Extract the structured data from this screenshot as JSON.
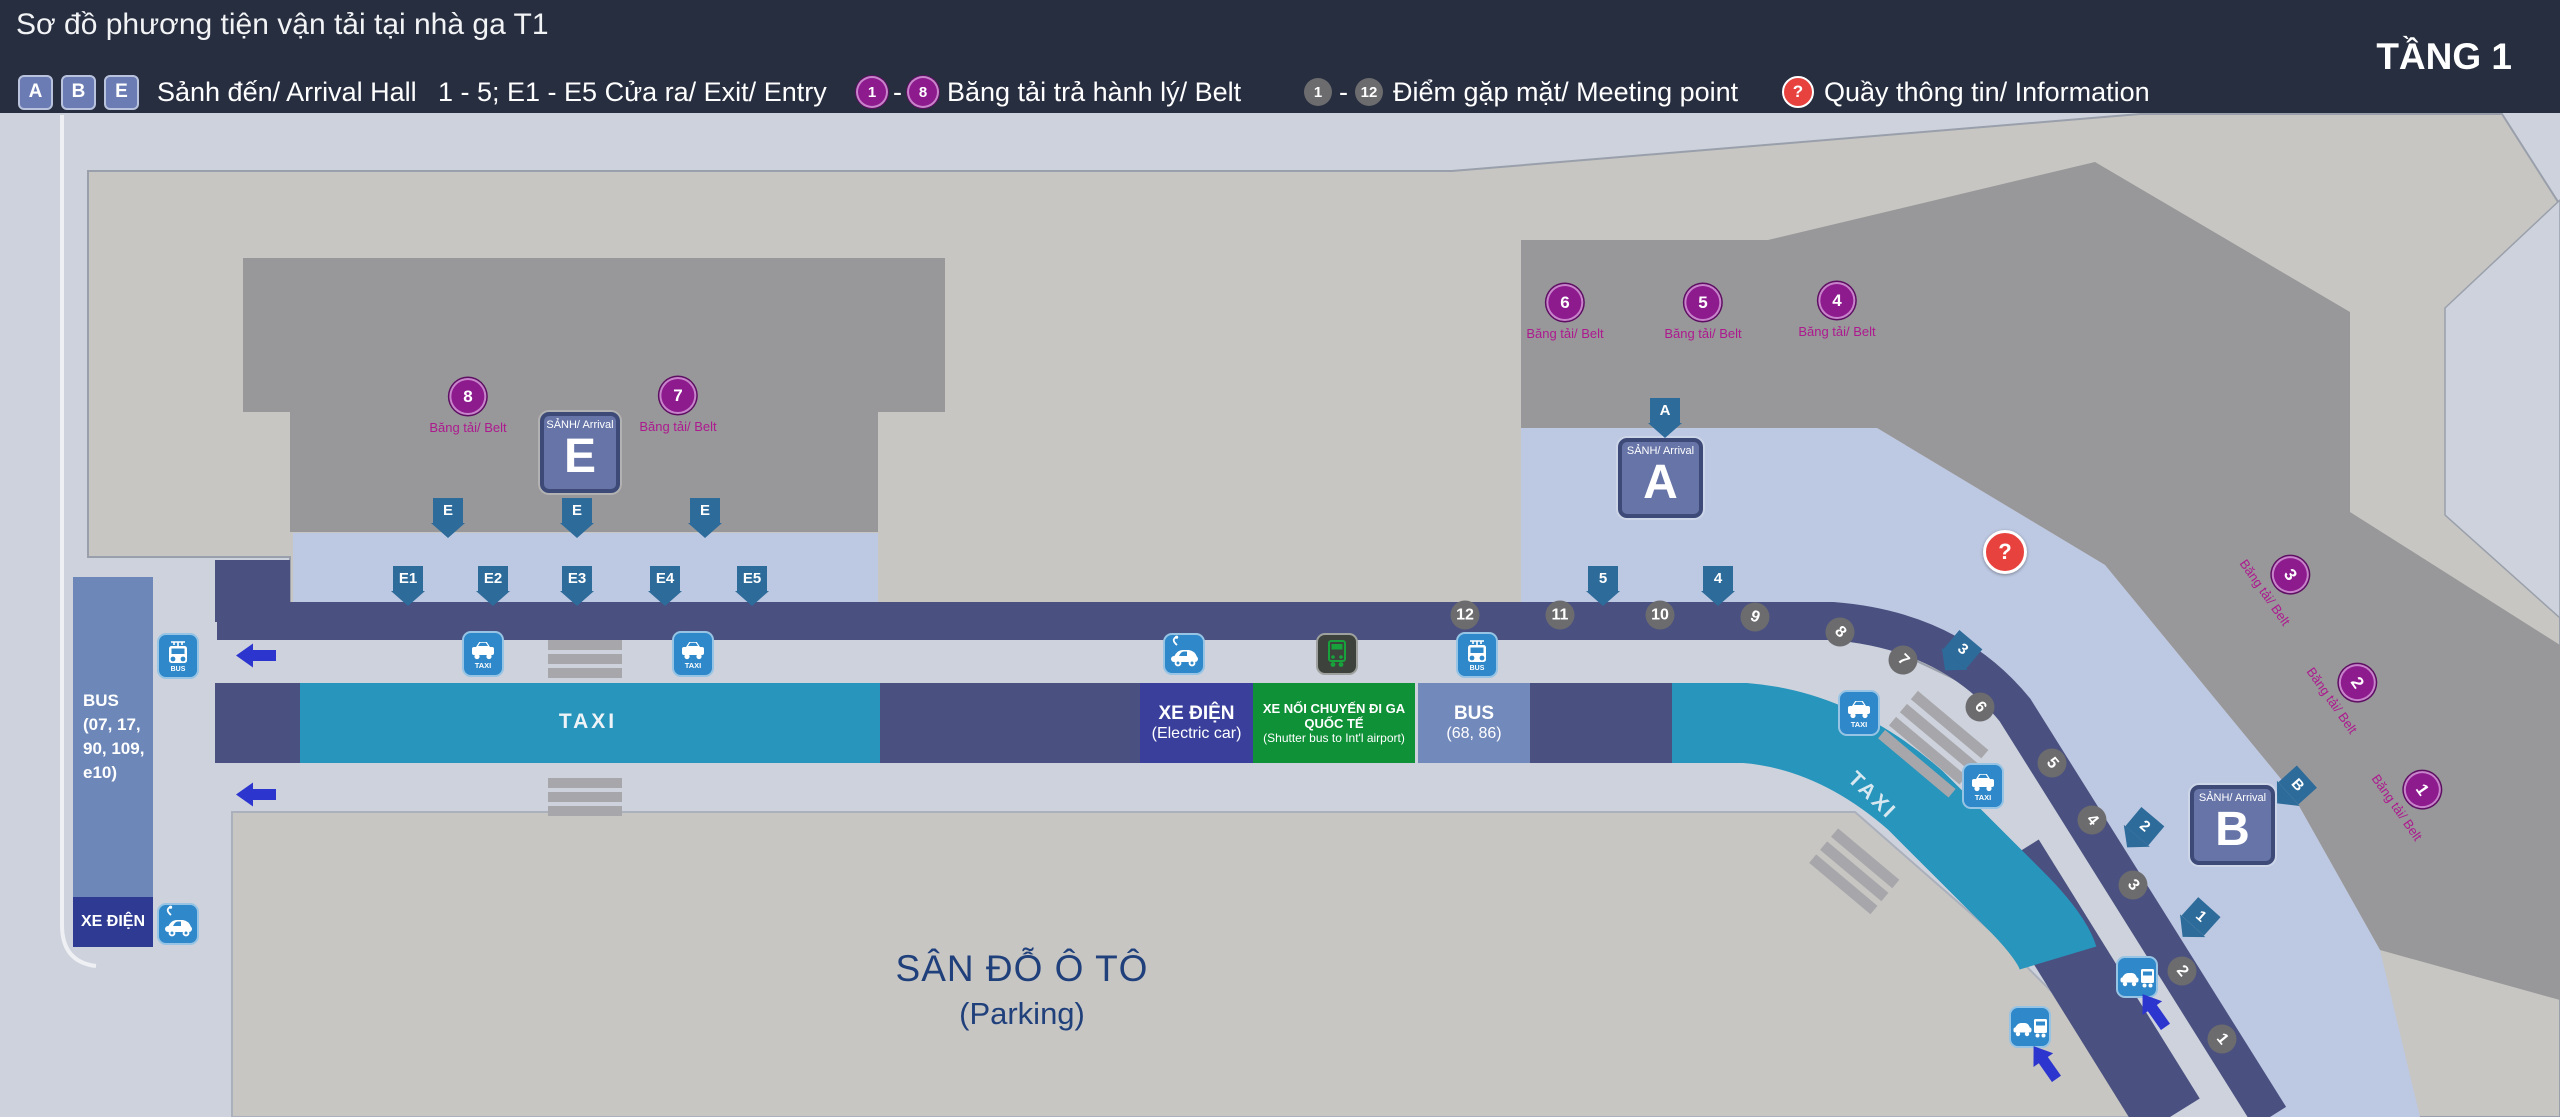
{
  "header": {
    "title": "Sơ đồ phương tiện vận tải tại nhà ga T1",
    "floor": "TẦNG 1",
    "legend": {
      "halls": {
        "badges": [
          "A",
          "B",
          "E"
        ],
        "label": "Sảnh đến/ Arrival Hall"
      },
      "exits": {
        "label": "1 - 5; E1 - E5 Cửa ra/ Exit/ Entry"
      },
      "belts": {
        "from": "1",
        "dash": "-",
        "to": "8",
        "label": "Băng tải trả hành lý/ Belt"
      },
      "meetings": {
        "from": "1",
        "dash": "-",
        "to": "12",
        "label": "Điểm gặp mặt/ Meeting point"
      },
      "info": {
        "symbol": "?",
        "label": "Quầy thông tin/ Information"
      }
    }
  },
  "map": {
    "parking": {
      "line1": "SÂN ĐỖ Ô TÔ",
      "line2": "(Parking)"
    },
    "bus_bay": {
      "lines": [
        "BUS",
        "(07, 17,",
        "90, 109,",
        "e10)"
      ]
    },
    "xe_dien_bay": {
      "label": "XE ĐIỆN"
    },
    "taxi_band": {
      "label": "TAXI"
    },
    "taxi_band_diagonal": {
      "label": "TAXI"
    },
    "boxes": {
      "electric": {
        "line1": "XE ĐIỆN",
        "line2": "(Electric car)"
      },
      "shuttle": {
        "line1": "XE NỐI CHUYẾN ĐI GA QUỐC TẾ",
        "line2": "(Shutter bus to Int'l airport)"
      },
      "bus": {
        "line1": "BUS",
        "line2": "(68, 86)"
      }
    },
    "arrival_boxes": [
      {
        "id": "E",
        "small": "SẢNH/ Arrival",
        "letter": "E",
        "x": 540,
        "y": 412,
        "w": 80,
        "h": 81
      },
      {
        "id": "A",
        "small": "SẢNH/ Arrival",
        "letter": "A",
        "x": 1618,
        "y": 438,
        "w": 85,
        "h": 80
      },
      {
        "id": "B",
        "small": "SẢNH/ Arrival",
        "letter": "B",
        "x": 2190,
        "y": 785,
        "w": 85,
        "h": 80
      }
    ],
    "info_point": {
      "symbol": "?",
      "x": 2005,
      "y": 552
    },
    "belt_label": "Băng tải/ Belt",
    "belts": [
      {
        "n": "8",
        "x": 468,
        "y": 397,
        "r": 0
      },
      {
        "n": "7",
        "x": 678,
        "y": 396,
        "r": 0
      },
      {
        "n": "6",
        "x": 1565,
        "y": 303,
        "r": 0
      },
      {
        "n": "5",
        "x": 1703,
        "y": 303,
        "r": 0
      },
      {
        "n": "4",
        "x": 1837,
        "y": 301,
        "r": 0
      },
      {
        "n": "3",
        "x": 2290,
        "y": 575,
        "r": 55
      },
      {
        "n": "2",
        "x": 2357,
        "y": 683,
        "r": 55
      },
      {
        "n": "1",
        "x": 2422,
        "y": 790,
        "r": 55
      }
    ],
    "meetings": [
      {
        "n": "12",
        "x": 1465,
        "y": 615,
        "r": 0
      },
      {
        "n": "11",
        "x": 1560,
        "y": 615,
        "r": 0
      },
      {
        "n": "10",
        "x": 1660,
        "y": 615,
        "r": 0
      },
      {
        "n": "9",
        "x": 1755,
        "y": 617,
        "r": 20
      },
      {
        "n": "8",
        "x": 1840,
        "y": 632,
        "r": 45
      },
      {
        "n": "7",
        "x": 1903,
        "y": 660,
        "r": 45
      },
      {
        "n": "6",
        "x": 1980,
        "y": 707,
        "r": 50
      },
      {
        "n": "5",
        "x": 2052,
        "y": 763,
        "r": 50
      },
      {
        "n": "4",
        "x": 2092,
        "y": 820,
        "r": 50
      },
      {
        "n": "3",
        "x": 2133,
        "y": 885,
        "r": 50
      },
      {
        "n": "2",
        "x": 2182,
        "y": 971,
        "r": 50
      },
      {
        "n": "1",
        "x": 2222,
        "y": 1039,
        "r": 50
      }
    ],
    "exits": [
      {
        "t": "E",
        "x": 448,
        "y": 498,
        "r": 0
      },
      {
        "t": "E",
        "x": 577,
        "y": 498,
        "r": 0
      },
      {
        "t": "E",
        "x": 705,
        "y": 498,
        "r": 0
      },
      {
        "t": "E1",
        "x": 408,
        "y": 566,
        "r": 0
      },
      {
        "t": "E2",
        "x": 493,
        "y": 566,
        "r": 0
      },
      {
        "t": "E3",
        "x": 577,
        "y": 566,
        "r": 0
      },
      {
        "t": "E4",
        "x": 665,
        "y": 566,
        "r": 0
      },
      {
        "t": "E5",
        "x": 752,
        "y": 566,
        "r": 0
      },
      {
        "t": "A",
        "x": 1665,
        "y": 398,
        "r": 0
      },
      {
        "t": "5",
        "x": 1603,
        "y": 566,
        "r": 0
      },
      {
        "t": "4",
        "x": 1718,
        "y": 566,
        "r": 0
      },
      {
        "t": "3",
        "x": 1958,
        "y": 635,
        "r": 40
      },
      {
        "t": "2",
        "x": 2140,
        "y": 812,
        "r": 40
      },
      {
        "t": "1",
        "x": 2196,
        "y": 902,
        "r": 42
      },
      {
        "t": "B",
        "x": 2292,
        "y": 770,
        "r": 48
      }
    ],
    "icons": [
      {
        "type": "bus",
        "x": 178,
        "y": 656,
        "label": "BUS"
      },
      {
        "type": "ecar",
        "x": 178,
        "y": 924,
        "label": ""
      },
      {
        "type": "taxi",
        "x": 483,
        "y": 654,
        "label": "TAXI"
      },
      {
        "type": "taxi",
        "x": 693,
        "y": 654,
        "label": "TAXI"
      },
      {
        "type": "ecar",
        "x": 1184,
        "y": 654,
        "label": ""
      },
      {
        "type": "shuttle",
        "x": 1337,
        "y": 654,
        "label": ""
      },
      {
        "type": "bus",
        "x": 1477,
        "y": 655,
        "label": "BUS"
      },
      {
        "type": "taxi",
        "x": 1859,
        "y": 713,
        "label": "TAXI"
      },
      {
        "type": "taxi",
        "x": 1983,
        "y": 786,
        "label": "TAXI"
      },
      {
        "type": "carbus",
        "x": 2137,
        "y": 977,
        "label": ""
      },
      {
        "type": "carbus",
        "x": 2030,
        "y": 1027,
        "label": ""
      }
    ],
    "blue_arrows": [
      {
        "x": 256,
        "y": 658,
        "r": 0
      },
      {
        "x": 256,
        "y": 797,
        "r": 0
      },
      {
        "x": 2152,
        "y": 1012,
        "r": 55
      },
      {
        "x": 2043,
        "y": 1064,
        "r": 55
      }
    ],
    "colors": {
      "header": "#272e40",
      "map_bg": "#cdd2dc",
      "building_light": "#c7c6c2",
      "building_dark": "#98989a",
      "arrival_strip": "#bdc8e2",
      "road_navy": "#4a5180",
      "taxi_teal": "#2795bc",
      "box_electric": "#3a3f9c",
      "box_shuttle_green": "#0f9138",
      "box_bus_steel": "#7289bb",
      "icon_blue": "#2e88c9",
      "exit_steel": "#2d6b9a",
      "direction_blue": "#2d35cf",
      "belt_purple": "#8d1b8e",
      "meeting_gray": "#6c6c6e",
      "info_red": "#e8423f"
    }
  }
}
